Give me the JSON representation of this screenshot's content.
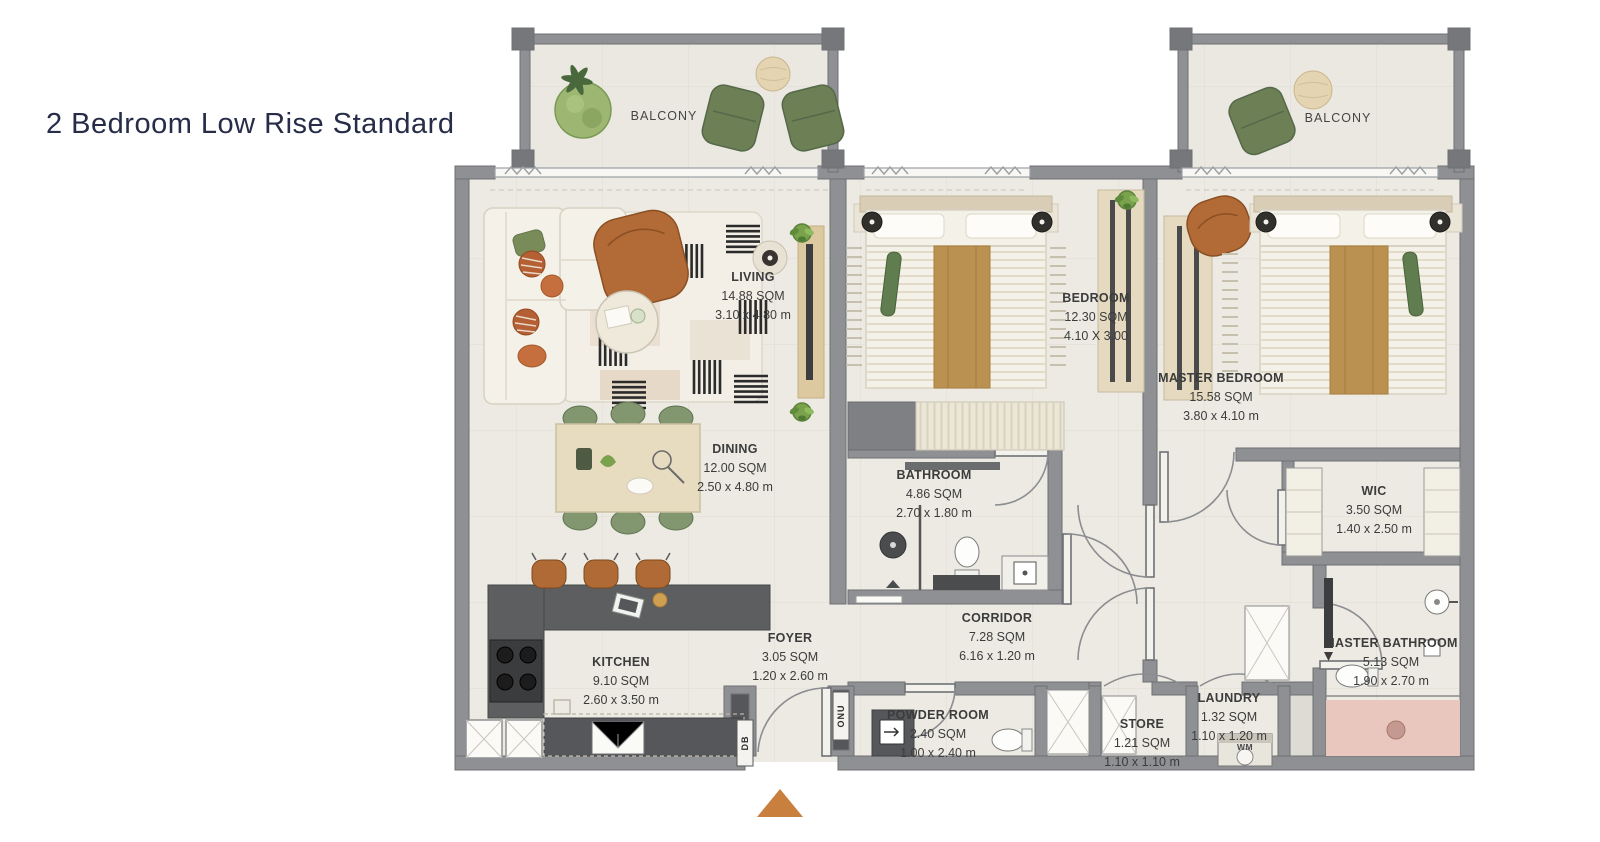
{
  "title": "2 Bedroom Low Rise Standard",
  "balconies": {
    "left": "BALCONY",
    "right": "BALCONY"
  },
  "rooms": {
    "living": {
      "name": "LIVING",
      "area": "14.88 SQM",
      "dims": "3.10 x 4.80 m"
    },
    "dining": {
      "name": "DINING",
      "area": "12.00 SQM",
      "dims": "2.50 x 4.80 m"
    },
    "kitchen": {
      "name": "KITCHEN",
      "area": "9.10 SQM",
      "dims": "2.60 x 3.50 m"
    },
    "foyer": {
      "name": "FOYER",
      "area": "3.05 SQM",
      "dims": "1.20 x 2.60 m"
    },
    "bedroom": {
      "name": "BEDROOM",
      "area": "12.30 SQM",
      "dims": "4.10 X 3.00"
    },
    "bathroom": {
      "name": "BATHROOM",
      "area": "4.86 SQM",
      "dims": "2.70 x 1.80 m"
    },
    "master_bedroom": {
      "name": "MASTER BEDROOM",
      "area": "15.58 SQM",
      "dims": "3.80 x 4.10 m"
    },
    "wic": {
      "name": "WIC",
      "area": "3.50 SQM",
      "dims": "1.40 x 2.50 m"
    },
    "master_bathroom": {
      "name": "MASTER BATHROOM",
      "area": "5.13 SQM",
      "dims": "1.90 x 2.70 m"
    },
    "corridor": {
      "name": "CORRIDOR",
      "area": "7.28 SQM",
      "dims": "6.16 x 1.20 m"
    },
    "powder_room": {
      "name": "POWDER ROOM",
      "area": "2.40 SQM",
      "dims": "1.00 x 2.40 m"
    },
    "store": {
      "name": "STORE",
      "area": "1.21 SQM",
      "dims": "1.10 x 1.10 m"
    },
    "laundry": {
      "name": "LAUNDRY",
      "area": "1.32 SQM",
      "dims": "1.10 x 1.20 m"
    }
  },
  "utility_labels": {
    "db": "DB",
    "onu": "ONU",
    "wm": "WM"
  },
  "colors": {
    "wall": "#8e9093",
    "wall_dark": "#75777b",
    "floor": "#eceae3",
    "counter": "#5c5e60",
    "wood": "#e5dabf",
    "caramel": "#b26a36",
    "chair_green": "#6d7f55",
    "rug_stripe": "#2b2b2b",
    "pink_mat": "#e9c7be",
    "entry_arrow": "#c9803f",
    "title_text": "#272c49",
    "label_text": "#3c3c3c"
  }
}
